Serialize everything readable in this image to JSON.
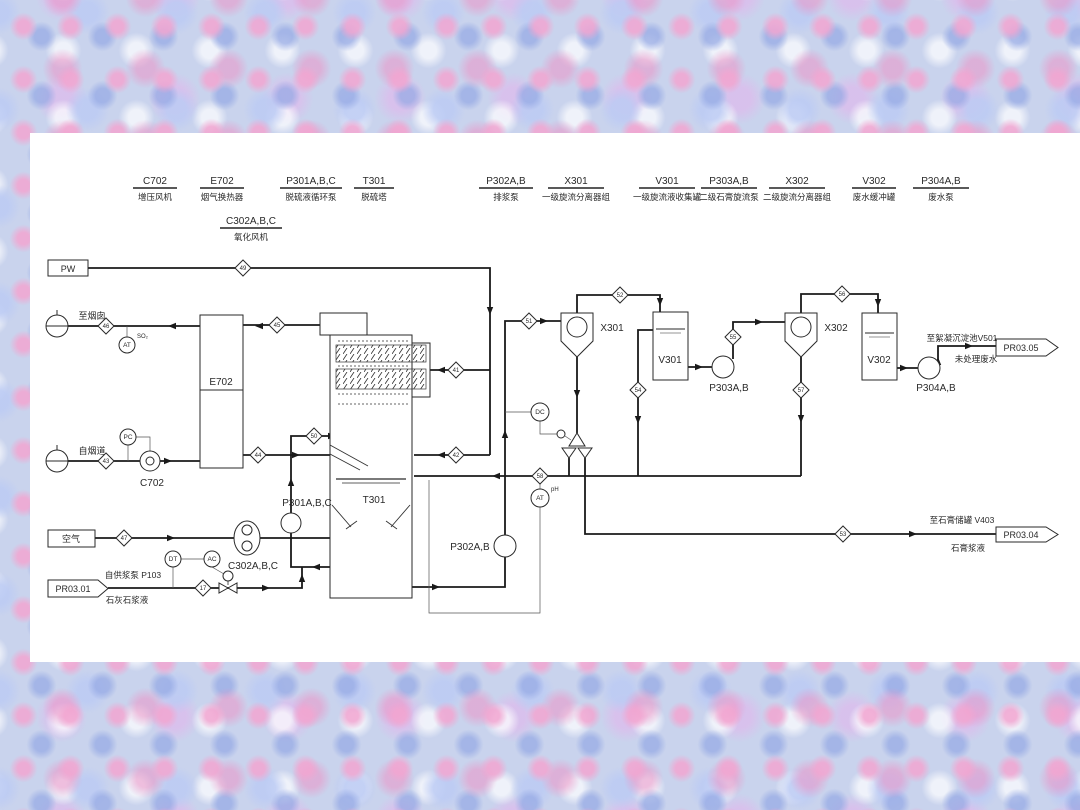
{
  "equipment_headers": {
    "row1": [
      {
        "tag": "C702",
        "desc": "增压风机"
      },
      {
        "tag": "E702",
        "desc": "烟气换热器"
      },
      {
        "tag": "P301A,B,C",
        "desc": "脱硫液循环泵"
      },
      {
        "tag": "T301",
        "desc": "脱硫塔"
      },
      {
        "tag": "P302A,B",
        "desc": "排浆泵"
      },
      {
        "tag": "X301",
        "desc": "一级旋流分离器组"
      },
      {
        "tag": "V301",
        "desc": "一级旋流液收集罐"
      },
      {
        "tag": "P303A,B",
        "desc": "二级石膏旋流泵"
      },
      {
        "tag": "X302",
        "desc": "二级旋流分离器组"
      },
      {
        "tag": "V302",
        "desc": "废水缓冲罐"
      },
      {
        "tag": "P304A,B",
        "desc": "废水泵"
      }
    ],
    "row2": [
      {
        "tag": "C302A,B,C",
        "desc": "氧化风机"
      }
    ]
  },
  "labels": {
    "c702": "C702",
    "e702": "E702",
    "t301": "T301",
    "p301": "P301A,B,C",
    "c302": "C302A,B,C",
    "p302": "P302A,B",
    "x301": "X301",
    "v301": "V301",
    "p303": "P303A,B",
    "x302": "X302",
    "v302": "V302",
    "p304": "P304A,B"
  },
  "streams": {
    "pw": "PW",
    "to_stack": "至烟囱",
    "from_flue": "自烟道",
    "air": "空气",
    "pr0301": "PR03.01",
    "from_supply_pump": "自供浆泵 P103",
    "limestone_slurry": "石灰石浆液",
    "pr0304": "PR03.04",
    "to_gypsum_tank": "至石膏储罐 V403",
    "gypsum_slurry": "石膏浆液",
    "pr0305": "PR03.05",
    "to_settling_tank": "至絮凝沉淀池V501",
    "untreated_wastewater": "未处理废水"
  },
  "instruments": {
    "at_so2": "AT",
    "at_so2_sup": "SO₂",
    "pc": "PC",
    "dc": "DC",
    "at_ph": "AT",
    "at_ph_sup": "pH",
    "dt": "DT",
    "ac": "AC"
  },
  "nums": {
    "n17": "17",
    "n41": "41",
    "n42": "42",
    "n43": "43",
    "n44": "44",
    "n45": "45",
    "n46": "46",
    "n47": "47",
    "n49": "49",
    "n50": "50",
    "n51": "51",
    "n52": "52",
    "n53": "53",
    "n54": "54",
    "n55": "55",
    "n56": "56",
    "n57": "57",
    "n58": "58"
  }
}
